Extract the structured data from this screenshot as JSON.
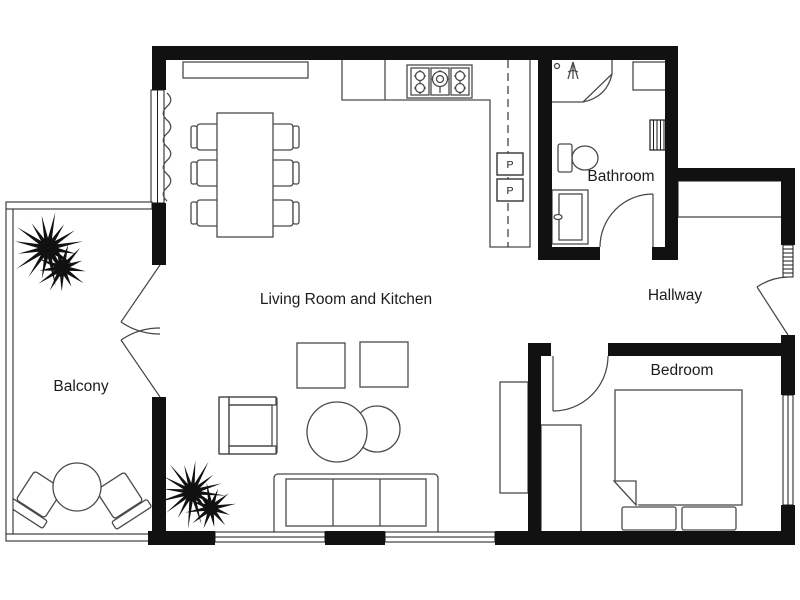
{
  "floor_plan": {
    "rooms": [
      {
        "id": "living-kitchen",
        "label": "Living Room and Kitchen"
      },
      {
        "id": "bathroom",
        "label": "Bathroom"
      },
      {
        "id": "hallway",
        "label": "Hallway"
      },
      {
        "id": "bedroom",
        "label": "Bedroom"
      },
      {
        "id": "balcony",
        "label": "Balcony"
      }
    ],
    "appliances": {
      "kitchen_unit_1": "P",
      "kitchen_unit_2": "P"
    },
    "colors": {
      "wall": "#111111",
      "furniture_outline": "#4a4a4a",
      "window_line": "#1a1a1a",
      "background": "#ffffff",
      "text": "#1c1c1c"
    }
  }
}
